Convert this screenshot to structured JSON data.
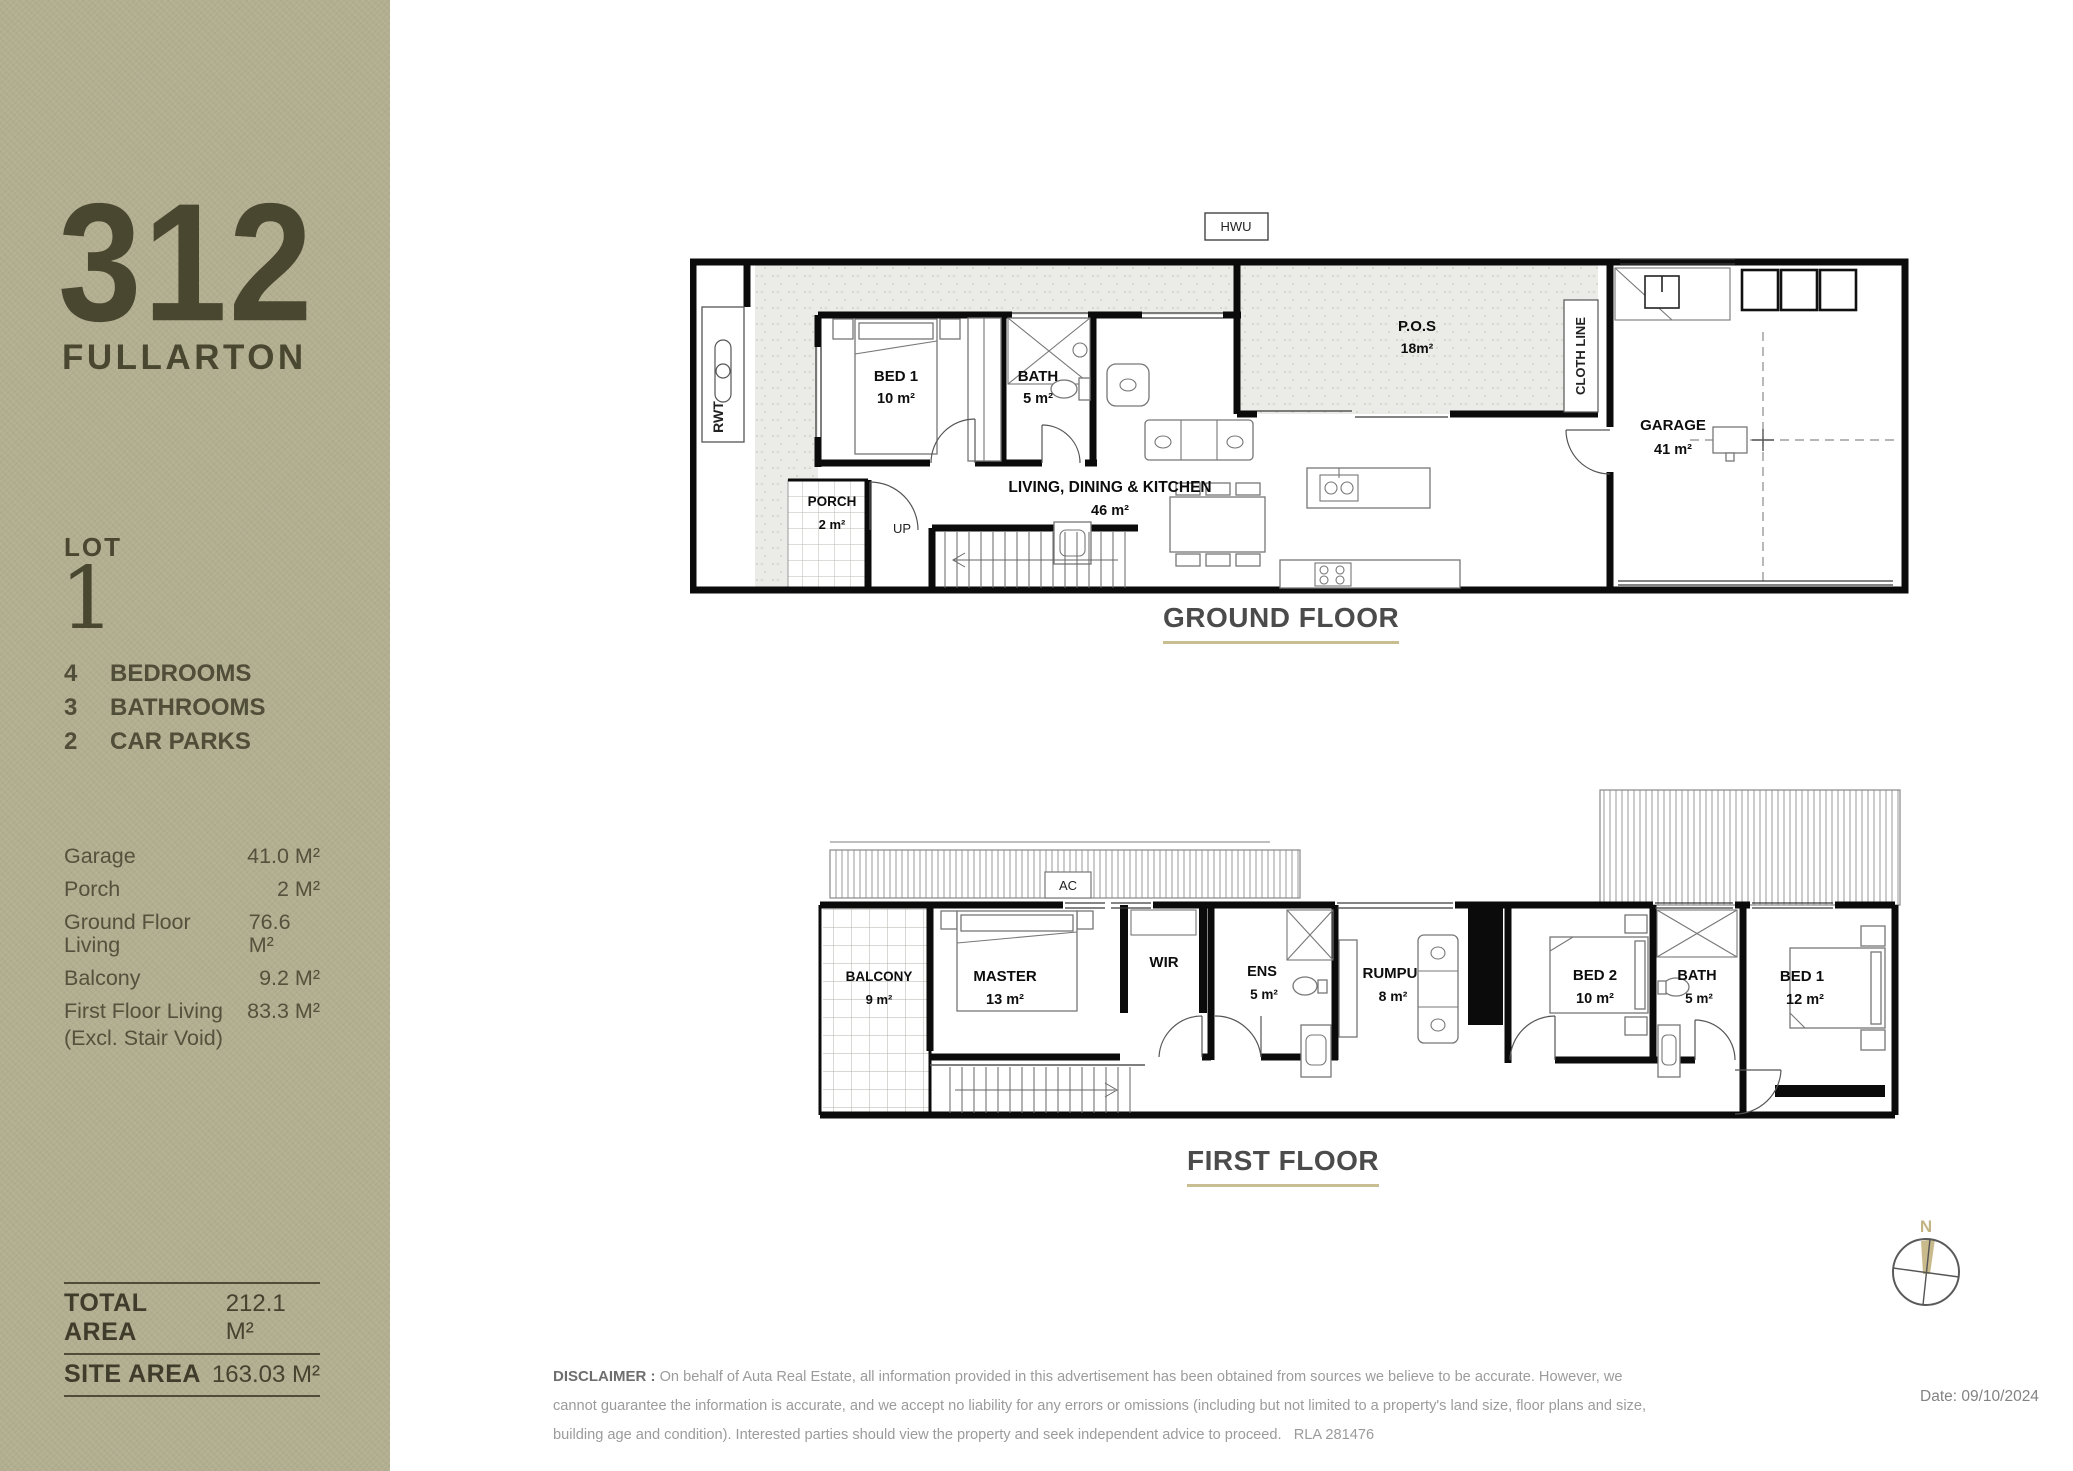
{
  "sidebar": {
    "street_number": "312",
    "street_name": "FULLARTON",
    "lot_label": "LOT",
    "lot_number": "1",
    "features": [
      {
        "count": "4",
        "label": "BEDROOMS"
      },
      {
        "count": "3",
        "label": "BATHROOMS"
      },
      {
        "count": "2",
        "label": "CAR PARKS"
      }
    ],
    "areas": [
      {
        "label": "Garage",
        "value": "41.0 M²"
      },
      {
        "label": "Porch",
        "value": "2 M²"
      },
      {
        "label": "Ground Floor Living",
        "value": "76.6 M²"
      },
      {
        "label": "Balcony",
        "value": "9.2 M²"
      },
      {
        "label": "First Floor Living",
        "sublabel": "(Excl. Stair Void)",
        "value": "83.3 M²"
      }
    ],
    "totals": [
      {
        "label": "TOTAL AREA",
        "value": "212.1  M²"
      },
      {
        "label": "SITE AREA",
        "value": "163.03  M²"
      }
    ]
  },
  "plans": {
    "ground": {
      "title": "GROUND FLOOR",
      "labels": {
        "rwt": "RWT",
        "hwu": "HWU",
        "bed1": "BED 1",
        "bed1_area": "10 m²",
        "bath": "BATH",
        "bath_area": "5 m²",
        "living": "LIVING, DINING & KITCHEN",
        "living_area": "46 m²",
        "porch": "PORCH",
        "porch_area": "2 m²",
        "up": "UP",
        "pos": "P.O.S",
        "pos_area": "18m²",
        "cloth_line": "CLOTH LINE",
        "garage": "GARAGE",
        "garage_area": "41 m²"
      }
    },
    "first": {
      "title": "FIRST FLOOR",
      "labels": {
        "ac": "AC",
        "balcony": "BALCONY",
        "balcony_area": "9 m²",
        "master": "MASTER",
        "master_area": "13 m²",
        "wir": "WIR",
        "ens": "ENS",
        "ens_area": "5 m²",
        "rumpu": "RUMPU",
        "rumpu_area": "8 m²",
        "bed2": "BED 2",
        "bed2_area": "10 m²",
        "bath": "BATH",
        "bath_area": "5 m²",
        "bed1": "BED 1",
        "bed1_area": "12 m²"
      }
    }
  },
  "compass": {
    "north": "N"
  },
  "footer": {
    "disclaimer_label": "DISCLAIMER :",
    "disclaimer_text": "On behalf of Auta Real Estate, all information provided in this advertisement has been obtained from sources we believe to be accurate. However, we cannot guarantee the information is accurate, and we accept no liability for any errors or omissions (including but not limited to a property's land size, floor plans and size, building age and condition). Interested parties should view the property and seek independent advice to proceed.   RLA 281476",
    "date": "Date: 09/10/2024"
  },
  "colors": {
    "sidebar_bg": "#b2ae90",
    "sidebar_text": "#4a4731",
    "accent_underline": "#c9bd92",
    "heading_text": "#4b4b4b",
    "wall": "#0b0b0b"
  }
}
